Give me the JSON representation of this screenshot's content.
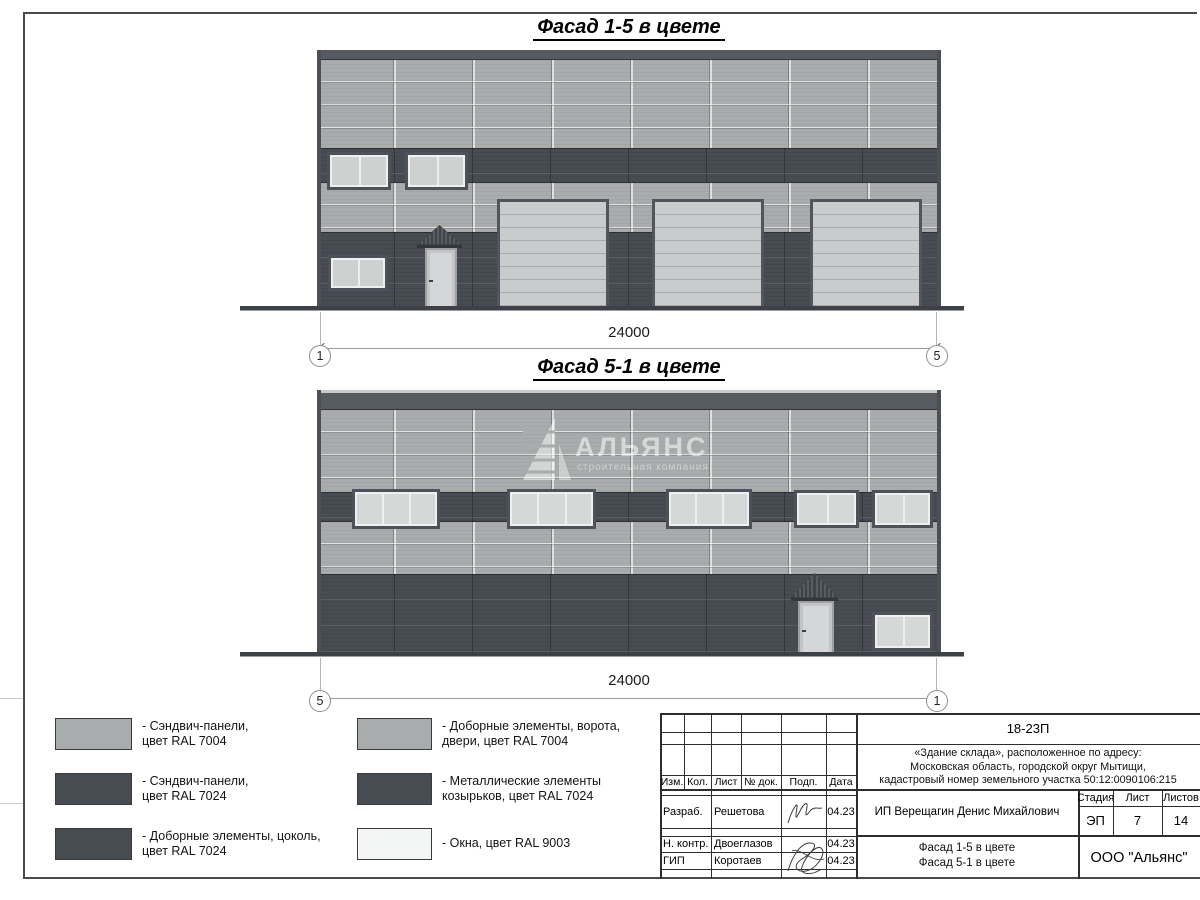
{
  "colors": {
    "panel_light": "#a9acac",
    "panel_dark": "#474c53",
    "parapet": "#565b62",
    "window_glass": "#cfd1d1",
    "gate_fill": "#c9cbcc",
    "ground": "#3c4147"
  },
  "facade1": {
    "title": "Фасад 1-5 в цвете",
    "dimension": "24000",
    "axis_left": "1",
    "axis_right": "5"
  },
  "facade2": {
    "title": "Фасад 5-1 в цвете",
    "dimension": "24000",
    "axis_left": "5",
    "axis_right": "1",
    "watermark": {
      "name": "АЛЬЯНС",
      "subtitle": "строительная компания"
    }
  },
  "legend": {
    "items": [
      {
        "label": "- Сэндвич-панели,\nцвет RAL 7004"
      },
      {
        "label": "- Сэндвич-панели,\nцвет RAL 7024"
      },
      {
        "label": "- Доборные элементы, цоколь,\nцвет RAL 7024"
      },
      {
        "label": "- Доборные элементы, ворота,\nдвери, цвет RAL 7004"
      },
      {
        "label": "- Металлические элементы\nкозырьков, цвет RAL 7024"
      },
      {
        "label": "- Окна, цвет RAL 9003"
      }
    ]
  },
  "stamp": {
    "project_code": "18-23П",
    "address_line1": "«Здание склада», расположенное по адресу:",
    "address_line2": "Московская область, городской округ Мытищи,",
    "address_line3": "кадастровый номер земельного участка 50:12:0090106:215",
    "col_izm": "Изм.",
    "col_kol": "Кол.",
    "col_list": "Лист",
    "col_doc": "№ док.",
    "col_podp": "Подп.",
    "col_data": "Дата",
    "rows": [
      {
        "role": "Разраб.",
        "name": "Решетова",
        "date": "04.23"
      },
      {
        "role": "Н. контр.",
        "name": "Двоеглазов",
        "date": "04.23"
      },
      {
        "role": "ГИП",
        "name": "Коротаев",
        "date": "04.23"
      }
    ],
    "client": "ИП Верещагин Денис Михайлович",
    "stage_label": "Стадия",
    "sheet_label": "Лист",
    "sheets_label": "Листов",
    "stage": "ЭП",
    "sheet": "7",
    "sheets": "14",
    "drawing_title_line1": "Фасад 1-5 в цвете",
    "drawing_title_line2": "Фасад 5-1 в цвете",
    "company": "ООО \"Альянс\""
  }
}
